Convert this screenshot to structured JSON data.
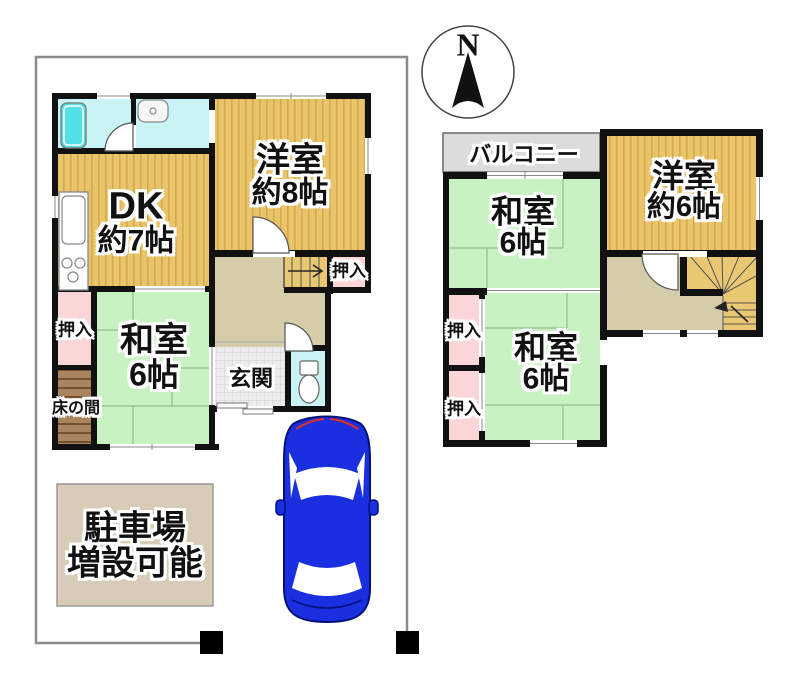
{
  "compass": {
    "label": "N"
  },
  "floor1": {
    "rooms": {
      "dk": {
        "line1": "DK",
        "line2": "約7帖"
      },
      "western_room": {
        "line1": "洋室",
        "line2": "約8帖"
      },
      "japanese_room": {
        "line1": "和室",
        "line2": "6帖"
      },
      "closet_by_stairs": {
        "label": "押入"
      },
      "closet_left": {
        "label": "押入"
      },
      "tokonoma": {
        "label": "床の間"
      },
      "entrance": {
        "label": "玄関"
      }
    },
    "parking": {
      "line1": "駐車場",
      "line2": "増設可能"
    }
  },
  "floor2": {
    "rooms": {
      "balcony": {
        "label": "バルコニー"
      },
      "japanese_room_upper": {
        "line1": "和室",
        "line2": "6帖"
      },
      "western_room": {
        "line1": "洋室",
        "line2": "約6帖"
      },
      "japanese_room_lower": {
        "line1": "和室",
        "line2": "6帖"
      },
      "closet_upper": {
        "label": "押入"
      },
      "closet_lower": {
        "label": "押入"
      }
    }
  },
  "colors": {
    "wall_black": "#111111",
    "wood_floor": "#e9c46b",
    "wood_stripe": "#d5aa4e",
    "stairs_tan": "#eac873",
    "tatami_green": "#c9f2c3",
    "closet_pink": "#fad6d6",
    "hall_beige": "#d6cca9",
    "tile_gray": "#ececec",
    "bath_cyan": "#c9f3f5",
    "tub_cyan": "#52e0e6",
    "balcony_gray": "#dcdcdc",
    "tokonoma_brown": "#a8855f",
    "parking_beige": "#d8ccb8",
    "car_blue": "#1a2fe0",
    "boundary_gray": "#8a8a8a"
  }
}
